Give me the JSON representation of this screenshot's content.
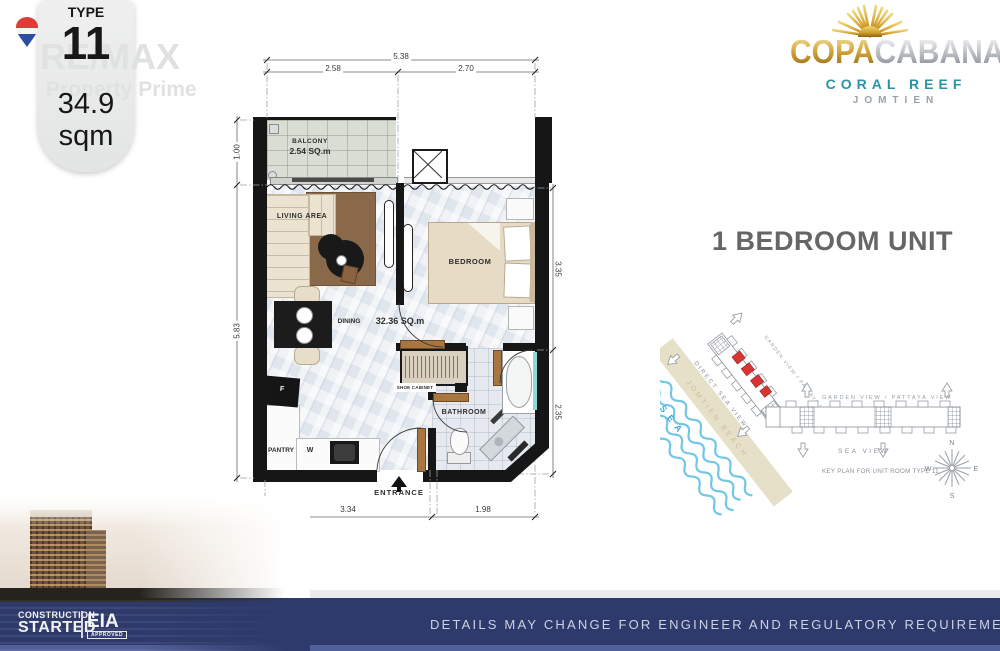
{
  "badge": {
    "type_label": "TYPE",
    "type_number": "11",
    "area_value": "34.9",
    "area_unit": "sqm"
  },
  "watermark": {
    "line1": "RE/MAX",
    "line2": "Property Prime"
  },
  "logo": {
    "name_gold": "COPA",
    "name_silver": "CABANA",
    "line2": "CORAL REEF",
    "line3": "JOMTIEN"
  },
  "unit_title": "1 BEDROOM UNIT",
  "floorplan": {
    "dims": {
      "top_total": "5.38",
      "top_left": "2.58",
      "top_right": "2.70",
      "left_top": "1.00",
      "left_main": "5.83",
      "right_top": "3.35",
      "right_bottom": "2.35",
      "bottom_left": "3.34",
      "bottom_right": "1.98"
    },
    "rooms": {
      "balcony": "BALCONY",
      "balcony_area": "2.54 SQ.m",
      "living": "LIVING AREA",
      "bedroom": "BEDROOM",
      "dining": "DINING",
      "interior_area": "32.36 SQ.m",
      "shoe_cabinet": "SHOE CABINET",
      "bathroom": "BATHROOM",
      "pantry": "PANTRY",
      "washer": "W",
      "fridge": "F",
      "entrance": "ENTRANCE"
    }
  },
  "keyplan": {
    "garden_view_diагonal": "GARDEN VIEW / PATTAYA VIEW",
    "garden_view_diagonal": "GARDEN VIEW / PATTAYA VIEW",
    "garden_view_horizontal": "GARDEN VIEW / PATTAYA VIEW",
    "direct_sea_view": "DIRECT SEA VIEW",
    "sea_view": "SEA VIEW",
    "sea": "SEA",
    "beach": "JOMTIEN BEACH",
    "caption": "KEY PLAN FOR UNIT ROOM TYPE 11",
    "compass": {
      "n": "N",
      "e": "E",
      "s": "S",
      "w": "W"
    },
    "highlight_color": "#d83434"
  },
  "footer": {
    "bar_text": "DETAILS MAY CHANGE FOR ENGINEER AND REGULATORY REQUIREMENTS.",
    "construction_line1": "CONSTRUCTION",
    "construction_line2": "STARTED",
    "eia": "EIA",
    "eia_sub": "APPROVED"
  },
  "colors": {
    "navy": "#2e3a6b",
    "gold": "#d1a436",
    "teal": "#2b93a8",
    "red": "#d83434",
    "sand": "#e3dabf",
    "wave": "#72c7e6"
  }
}
